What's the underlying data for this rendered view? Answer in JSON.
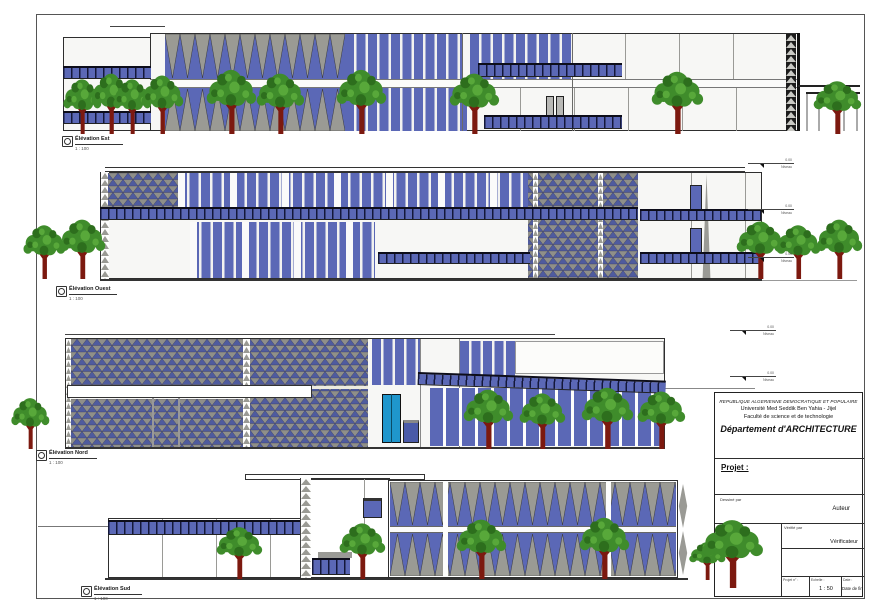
{
  "sheet": {
    "elevations": [
      {
        "title": "Élévation Est",
        "scale": "1 : 100"
      },
      {
        "title": "Élévation Ouest",
        "scale": "1 : 100"
      },
      {
        "title": "Élévation Nord",
        "scale": "1 : 100"
      },
      {
        "title": "Élévation Sud",
        "scale": "1 : 100"
      }
    ],
    "annotations": {
      "level_value": "0.00",
      "level_name": "Niveau"
    },
    "title_block": {
      "republic": "REPUBLIQUE ALGERIENNE DEMOCRATIQUE ET POPULAIRE",
      "university": "Université Med Seddik Ben Yahia - Jijel",
      "faculty": "Faculté de science et de technologie",
      "department": "Département d'ARCHITECTURE",
      "project_label": "Projet :",
      "drawn_by_label": "Dessiné par",
      "drawn_by_value": "Auteur",
      "plans_label": "Plans :",
      "checked_by_label": "Vérifié par",
      "checked_by_value": "Vérificateur",
      "project_number_label": "Projet n° :",
      "scale_label": "Echelle :",
      "scale_value": "1 : 50",
      "date_label": "Date :",
      "date_value": "Date de fin"
    },
    "colors": {
      "glazing_blue": "#5b68b6",
      "louver_gray": "#9a9a94",
      "lattice_blue": "#4f5b9e",
      "railing_navy": "#39406e",
      "tree_green": "#3f8c2b",
      "trunk_red": "#7c190f",
      "door_teal": "#1f96cc"
    }
  }
}
